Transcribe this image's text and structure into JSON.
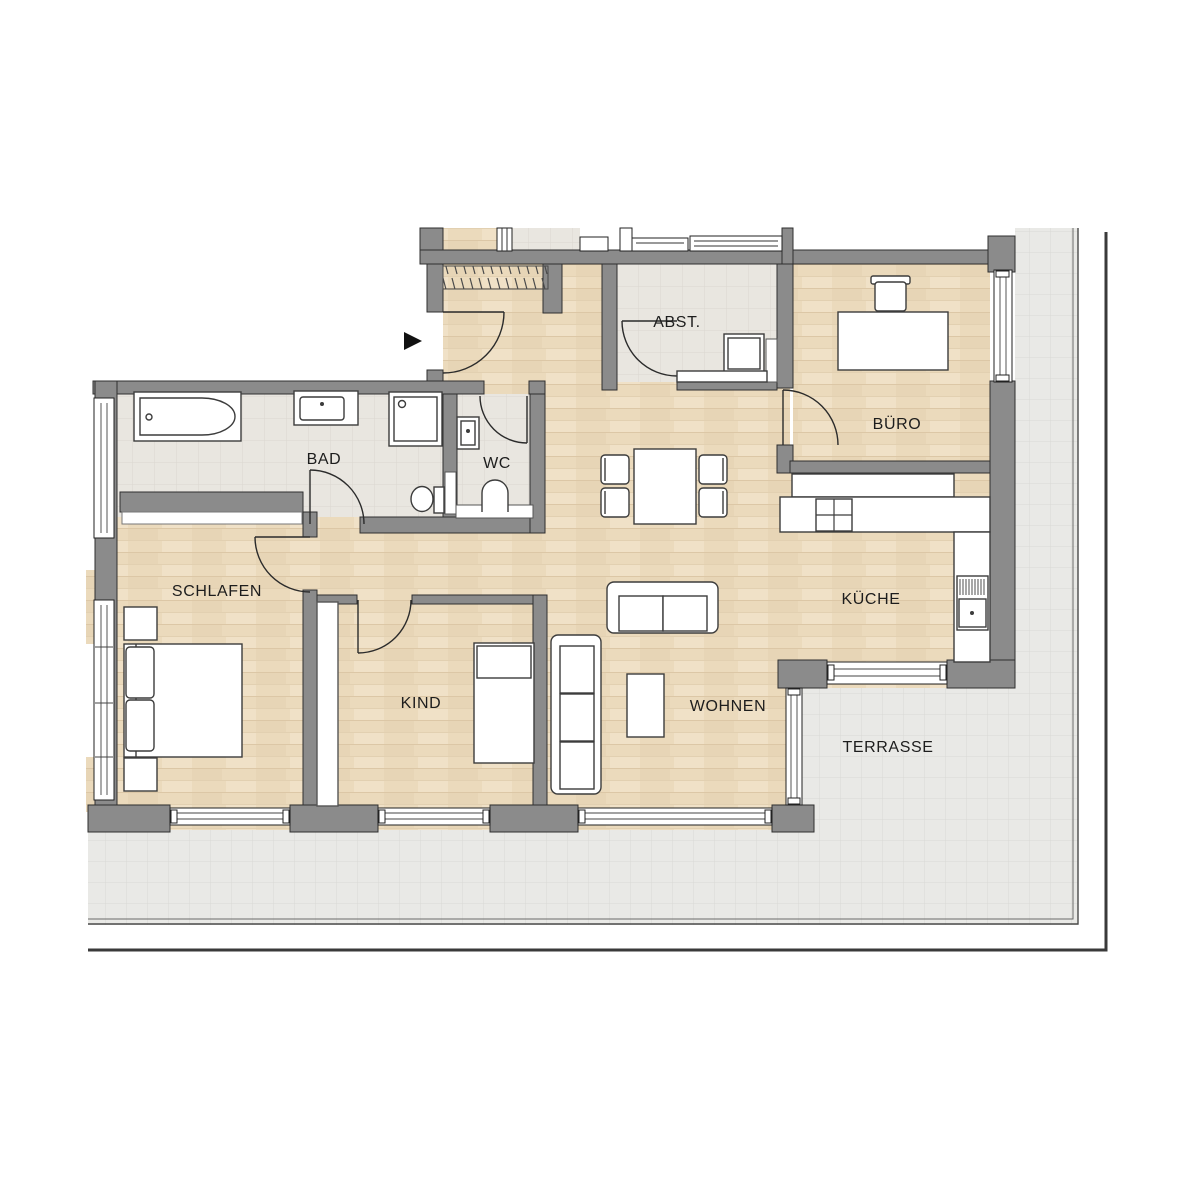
{
  "plan": {
    "type": "apartment-floor-plan",
    "rooms": [
      {
        "id": "schlafen",
        "label": "SCHLAFEN"
      },
      {
        "id": "kind",
        "label": "KIND"
      },
      {
        "id": "wohnen",
        "label": "WOHNEN"
      },
      {
        "id": "kueche",
        "label": "KÜCHE"
      },
      {
        "id": "buero",
        "label": "BÜRO"
      },
      {
        "id": "abstellraum",
        "label": "ABST."
      },
      {
        "id": "bad",
        "label": "BAD"
      },
      {
        "id": "wc",
        "label": "WC"
      },
      {
        "id": "terrasse",
        "label": "TERRASSE"
      }
    ],
    "entry_marker": {
      "glyph": "▶",
      "meaning": "apartment-entrance"
    },
    "colors": {
      "wall": "#8b8b8b",
      "wall_outline": "#2f2f2f",
      "wood_floor": "#ebdabc",
      "bath_tile": "#e9e6e0",
      "terrace_tile": "#e9e9e6",
      "furniture_fill": "#ffffff",
      "furniture_line": "#3c3c3c",
      "door_line": "#2b2b2b",
      "background": "#ffffff"
    },
    "fixtures": [
      "bathtub",
      "shower",
      "vanity-sink",
      "toilet",
      "wc-sink",
      "wc-toilet",
      "double-bed",
      "nightstand",
      "closet",
      "wardrobe",
      "single-bed",
      "sofa-3seat",
      "sofa-2seat",
      "coffee-table",
      "dining-table",
      "dining-chair",
      "kitchen-counter",
      "cooktop",
      "kitchen-sink",
      "desk",
      "desk-chair",
      "washing-machine",
      "coat-rack-hatch",
      "shelf"
    ]
  }
}
